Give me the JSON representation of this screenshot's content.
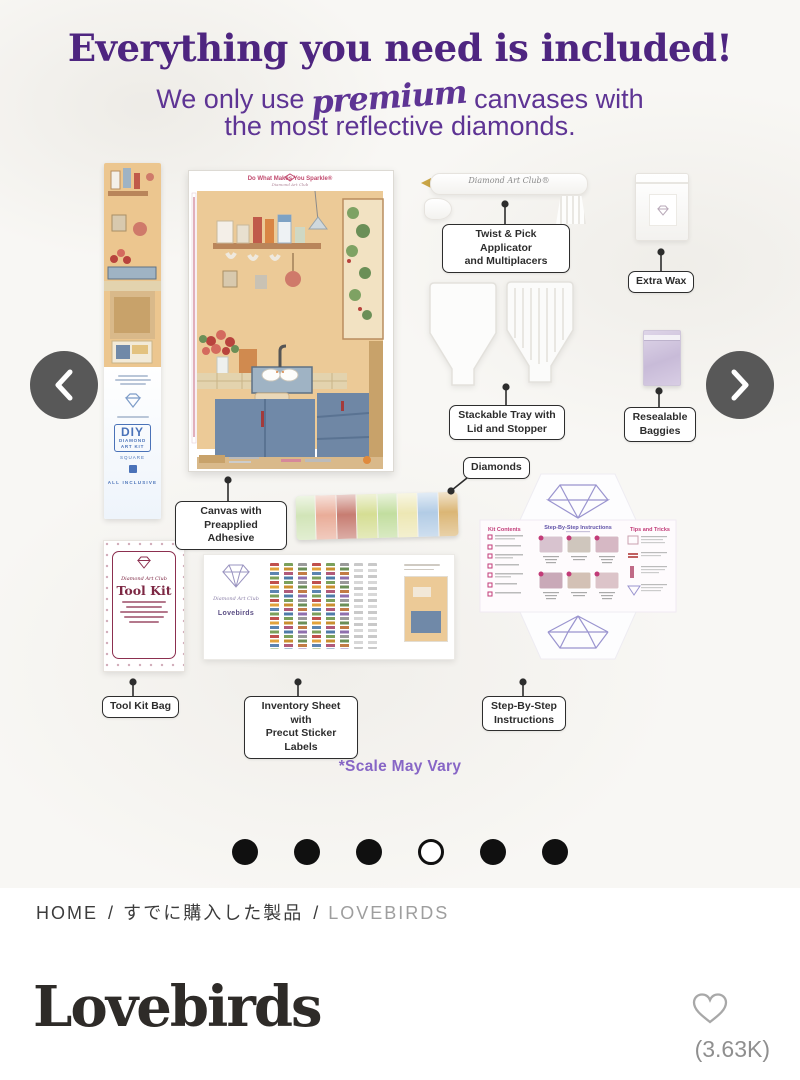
{
  "hero": {
    "headline": "Everything you need is included!",
    "subtitle": {
      "pre": "We only use",
      "script": "premium",
      "post": "canvases with",
      "line2": "the most reflective diamonds."
    },
    "scale_note": "*Scale May Vary"
  },
  "kit": {
    "canvas": {
      "header": "Do What Makes You Sparkle®",
      "brand": "Diamond Art Club"
    },
    "pen": {
      "brand": "Diamond Art Club®"
    },
    "box": {
      "diy": "DIY",
      "line1": "DIAMOND",
      "line2": "ART KIT",
      "drill": "SQUARE",
      "all_inclusive": "ALL INCLUSIVE"
    },
    "tool_kit": {
      "brand": "Diamond Art Club",
      "title": "Tool Kit"
    },
    "inventory": {
      "brand": "Diamond Art Club",
      "title": "Lovebirds"
    },
    "instructions": {
      "kit_contents": "Kit Contents",
      "title": "Step-By-Step Instructions",
      "tips": "Tips and Tricks"
    },
    "callouts": [
      {
        "id": "applicator",
        "text": "Twist & Pick Applicator\nand Multiplacers"
      },
      {
        "id": "extra-wax",
        "text": "Extra Wax"
      },
      {
        "id": "stackable-tray",
        "text": "Stackable Tray with\nLid and Stopper"
      },
      {
        "id": "resealable-baggies",
        "text": "Resealable\nBaggies"
      },
      {
        "id": "diamonds",
        "text": "Diamonds"
      },
      {
        "id": "canvas-adhesive",
        "text": "Canvas with\nPreapplied Adhesive"
      },
      {
        "id": "tool-kit-bag",
        "text": "Tool Kit Bag"
      },
      {
        "id": "inventory-sheet",
        "text": "Inventory Sheet with\nPrecut Sticker Labels"
      },
      {
        "id": "instructions",
        "text": "Step-By-Step\nInstructions"
      }
    ]
  },
  "carousel": {
    "dots": [
      {
        "active": false
      },
      {
        "active": false
      },
      {
        "active": false
      },
      {
        "active": true
      },
      {
        "active": false
      },
      {
        "active": false
      }
    ]
  },
  "breadcrumb": {
    "separator": "/",
    "items": [
      {
        "label": "HOME"
      },
      {
        "label": "すでに購入した製品"
      },
      {
        "label": "LOVEBIRDS"
      }
    ]
  },
  "product": {
    "title": "Lovebirds",
    "likes": "(3.63K)"
  },
  "colors": {
    "headline_purple": "#4e2580",
    "subtitle_purple": "#5e3494",
    "scale_note_purple": "#8766c6",
    "label_magenta": "#c23b78",
    "toolkit_maroon": "#8c2f4f",
    "arrow_gray": "#585858"
  }
}
